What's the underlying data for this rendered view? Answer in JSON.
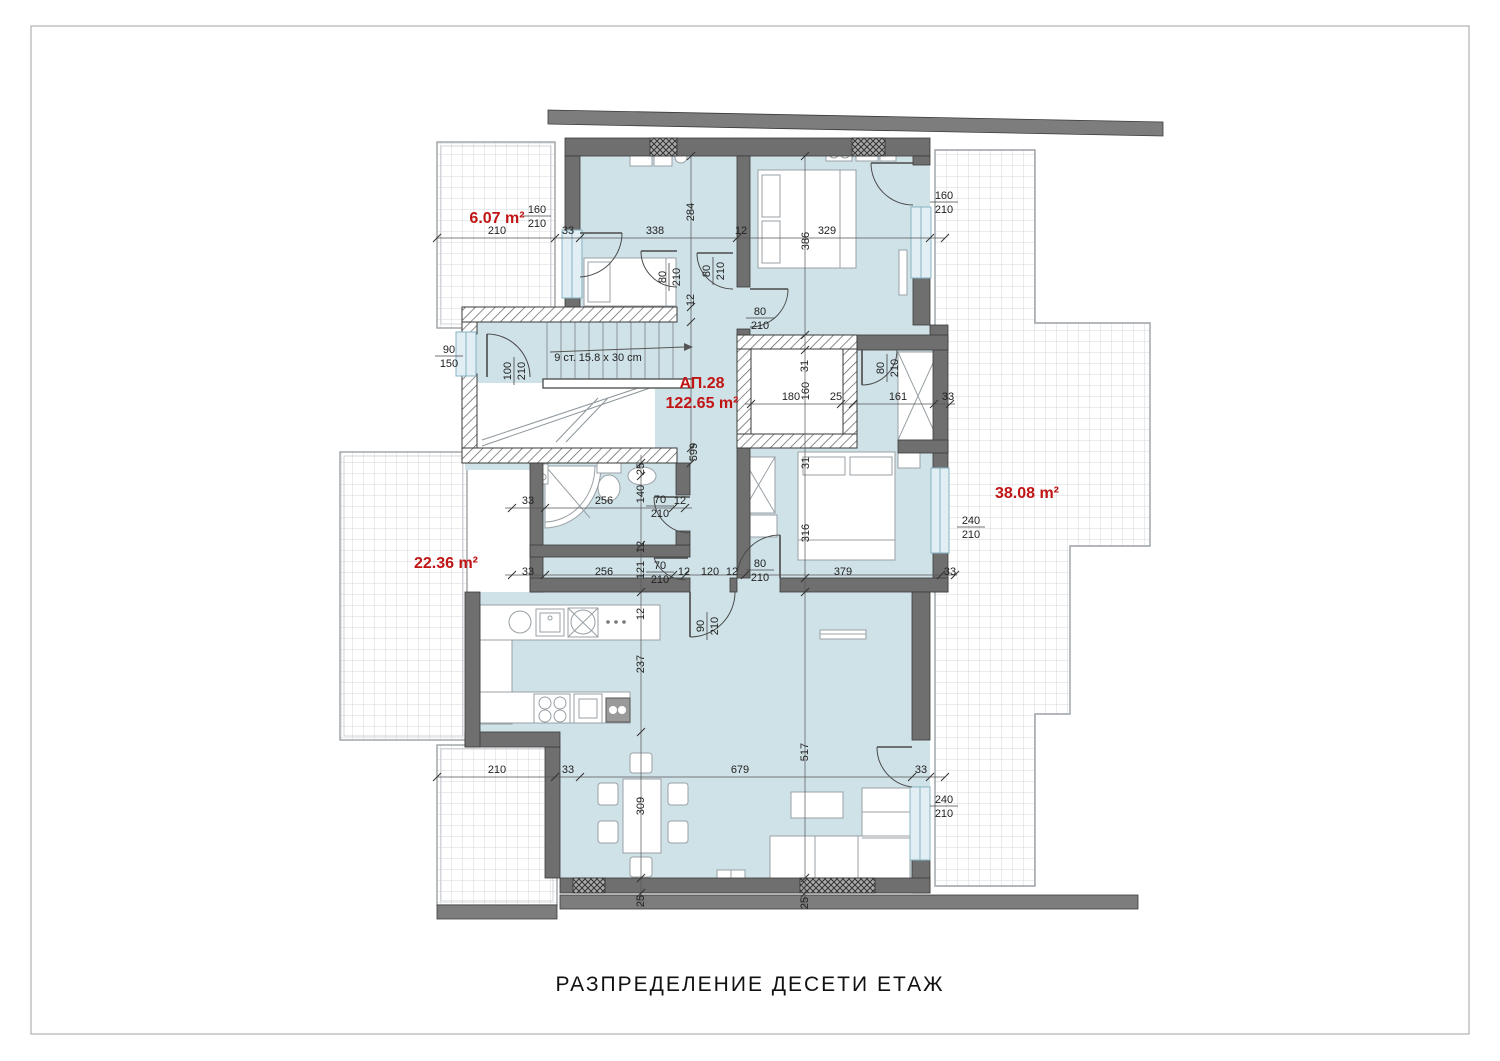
{
  "page": {
    "title": "РАЗПРЕДЕЛЕНИЕ ДЕСЕТИ ЕТАЖ"
  },
  "apartment": {
    "name": "АП.28",
    "area": "122.65 m²"
  },
  "notes": {
    "stairs": "9 ст. 15.8 x 30 cm"
  },
  "area_labels": [
    {
      "text": "6.07 m²",
      "x": 497,
      "y": 223
    },
    {
      "text": "22.36 m²",
      "x": 446,
      "y": 568
    },
    {
      "text": "38.08 m²",
      "x": 1027,
      "y": 498
    }
  ],
  "dimensions": [
    {
      "t": "210",
      "x": 497,
      "y": 234
    },
    {
      "t": "33",
      "x": 568,
      "y": 234
    },
    {
      "t": "338",
      "x": 655,
      "y": 234
    },
    {
      "t": "12",
      "x": 741,
      "y": 234
    },
    {
      "t": "329",
      "x": 827,
      "y": 234
    },
    {
      "t": "284",
      "x": 694,
      "y": 212,
      "r": -90
    },
    {
      "t": "386",
      "x": 809,
      "y": 241,
      "r": -90
    },
    {
      "t": "12",
      "x": 694,
      "y": 300,
      "r": -90
    },
    {
      "t": "599",
      "x": 697,
      "y": 452,
      "r": -90
    },
    {
      "t": "31",
      "x": 808,
      "y": 366,
      "r": -90
    },
    {
      "t": "160",
      "x": 809,
      "y": 391,
      "r": -90
    },
    {
      "t": "180",
      "x": 791,
      "y": 400
    },
    {
      "t": "25",
      "x": 836,
      "y": 400
    },
    {
      "t": "161",
      "x": 898,
      "y": 400
    },
    {
      "t": "33",
      "x": 948,
      "y": 400
    },
    {
      "t": "31",
      "x": 809,
      "y": 463,
      "r": -90
    },
    {
      "t": "316",
      "x": 809,
      "y": 533,
      "r": -90
    },
    {
      "t": "25",
      "x": 644,
      "y": 469,
      "r": -90
    },
    {
      "t": "140",
      "x": 644,
      "y": 494,
      "r": -90
    },
    {
      "t": "33",
      "x": 528,
      "y": 504
    },
    {
      "t": "256",
      "x": 604,
      "y": 504
    },
    {
      "t": "12",
      "x": 680,
      "y": 504
    },
    {
      "t": "12",
      "x": 644,
      "y": 547,
      "r": -90
    },
    {
      "t": "121",
      "x": 644,
      "y": 570,
      "r": -90
    },
    {
      "t": "33",
      "x": 528,
      "y": 575
    },
    {
      "t": "256",
      "x": 604,
      "y": 575
    },
    {
      "t": "12",
      "x": 684,
      "y": 575
    },
    {
      "t": "120",
      "x": 710,
      "y": 575
    },
    {
      "t": "12",
      "x": 732,
      "y": 575
    },
    {
      "t": "379",
      "x": 843,
      "y": 575
    },
    {
      "t": "33",
      "x": 950,
      "y": 575
    },
    {
      "t": "12",
      "x": 644,
      "y": 614,
      "r": -90
    },
    {
      "t": "237",
      "x": 644,
      "y": 664,
      "r": -90
    },
    {
      "t": "517",
      "x": 808,
      "y": 752,
      "r": -90
    },
    {
      "t": "210",
      "x": 497,
      "y": 773
    },
    {
      "t": "33",
      "x": 568,
      "y": 773
    },
    {
      "t": "679",
      "x": 740,
      "y": 773
    },
    {
      "t": "33",
      "x": 921,
      "y": 773
    },
    {
      "t": "309",
      "x": 644,
      "y": 806,
      "r": -90
    },
    {
      "t": "25",
      "x": 644,
      "y": 901,
      "r": -90
    },
    {
      "t": "25",
      "x": 808,
      "y": 903,
      "r": -90
    }
  ],
  "size_labels": [
    {
      "top": "160",
      "bottom": "210",
      "x": 537,
      "y": 216
    },
    {
      "top": "160",
      "bottom": "210",
      "x": 944,
      "y": 202
    },
    {
      "top": "90",
      "bottom": "150",
      "x": 449,
      "y": 356
    },
    {
      "top": "100",
      "bottom": "210",
      "x": 514,
      "y": 371,
      "r": -90
    },
    {
      "top": "80",
      "bottom": "210",
      "x": 669,
      "y": 277,
      "r": -90
    },
    {
      "top": "80",
      "bottom": "210",
      "x": 713,
      "y": 271,
      "r": -90
    },
    {
      "top": "80",
      "bottom": "210",
      "x": 760,
      "y": 318
    },
    {
      "top": "80",
      "bottom": "210",
      "x": 887,
      "y": 368,
      "r": -90
    },
    {
      "top": "70",
      "bottom": "210",
      "x": 660,
      "y": 506
    },
    {
      "top": "70",
      "bottom": "210",
      "x": 660,
      "y": 572
    },
    {
      "top": "80",
      "bottom": "210",
      "x": 760,
      "y": 570
    },
    {
      "top": "90",
      "bottom": "210",
      "x": 707,
      "y": 626,
      "r": -90
    },
    {
      "top": "240",
      "bottom": "210",
      "x": 971,
      "y": 527
    },
    {
      "top": "240",
      "bottom": "210",
      "x": 944,
      "y": 806
    }
  ],
  "colors": {
    "accent_red": "#c11414",
    "wall_gray": "#6f6f6f",
    "room_fill": "#cfe2e7",
    "dim_text": "#222222"
  }
}
